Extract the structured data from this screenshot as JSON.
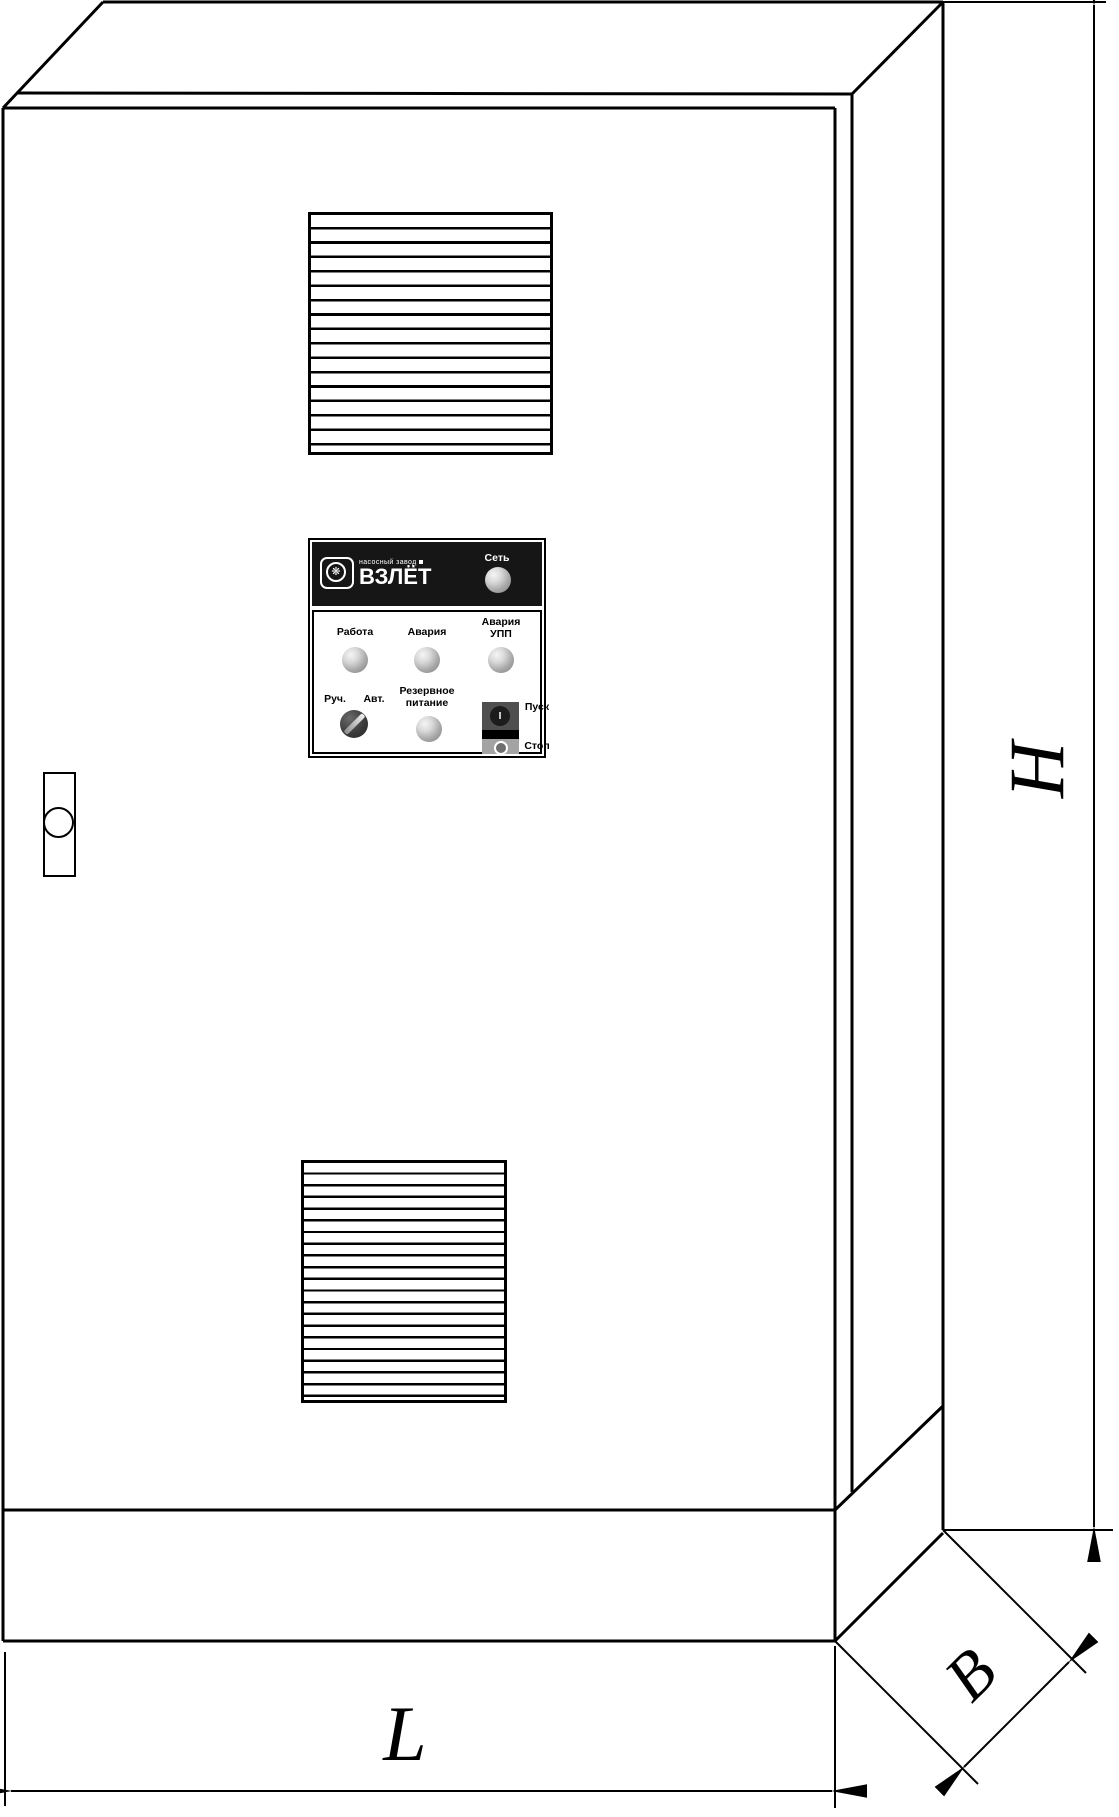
{
  "drawing": {
    "dimension_labels": {
      "height": "H",
      "length": "L",
      "depth": "B"
    }
  },
  "icons": {
    "impeller": "❋"
  },
  "panel": {
    "brand": {
      "subtitle": "насосный завод",
      "title": "ВЗЛЁТ"
    },
    "power_label": "Сеть",
    "indicators": {
      "run": "Работа",
      "alarm": "Авария",
      "alarm_soft_starter": [
        "Авария",
        "УПП"
      ],
      "reserve_power": [
        "Резервное",
        "питание"
      ]
    },
    "mode_switch": {
      "manual": "Руч.",
      "auto": "Авт."
    },
    "buttons": {
      "start": "Пуск",
      "stop": "Стоп",
      "start_glyph": "I"
    }
  }
}
